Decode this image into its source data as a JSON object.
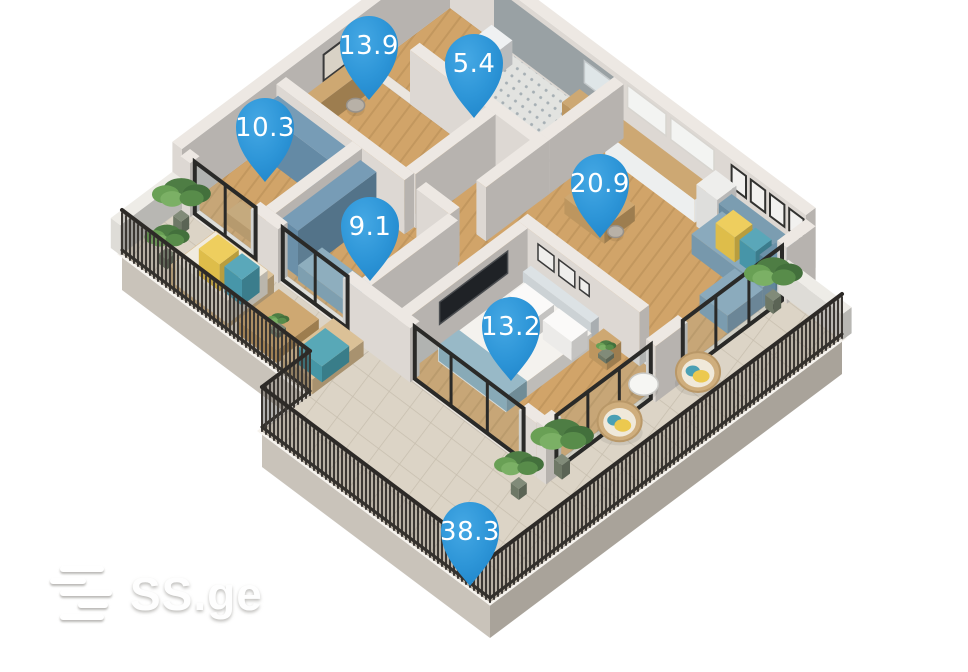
{
  "meta": {
    "width": 968,
    "height": 672,
    "background": "#ffffff"
  },
  "watermark": {
    "text": "SS.ge"
  },
  "pins": {
    "color": "#2e96d8",
    "text_color": "#ffffff",
    "items": [
      {
        "label": "13.9",
        "cx": 369,
        "cy": 45
      },
      {
        "label": "5.4",
        "cx": 474,
        "cy": 63
      },
      {
        "label": "10.3",
        "cx": 265,
        "cy": 127
      },
      {
        "label": "20.9",
        "cx": 600,
        "cy": 183
      },
      {
        "label": "9.1",
        "cx": 370,
        "cy": 226
      },
      {
        "label": "13.2",
        "cx": 511,
        "cy": 326
      },
      {
        "label": "38.3",
        "cx": 470,
        "cy": 531
      }
    ]
  },
  "scene": {
    "origin": {
      "x": 450,
      "y": 8
    },
    "kx": 0.8,
    "ky": 0.6,
    "items": [
      {
        "t": "skirt",
        "pts": [
          [
            0,
            410
          ],
          [
            235,
            410
          ],
          [
            235,
            470
          ],
          [
            520,
            470
          ],
          [
            520,
            30
          ]
        ],
        "depth": 36
      },
      {
        "t": "pf",
        "pts": [
          [
            0,
            0
          ],
          [
            445,
            0
          ],
          [
            445,
            30
          ],
          [
            520,
            30
          ],
          [
            520,
            470
          ],
          [
            235,
            470
          ],
          [
            235,
            410
          ],
          [
            0,
            410
          ]
        ],
        "f": "#ebe6df",
        "s": "#f6f3ee",
        "sw": 6
      },
      {
        "t": "pf",
        "pts": [
          [
            445,
            30
          ],
          [
            520,
            30
          ],
          [
            520,
            470
          ],
          [
            235,
            470
          ],
          [
            235,
            335
          ],
          [
            445,
            335
          ]
        ],
        "f": "@stone",
        "s": "rgba(120,108,90,0.25)",
        "sw": 1
      },
      {
        "t": "fl",
        "r": [
          0,
          335,
          235,
          410
        ],
        "f": "@stone"
      },
      {
        "t": "fl",
        "r": [
          0,
          0,
          55,
          95
        ],
        "f": "@wood"
      },
      {
        "t": "fl",
        "r": [
          55,
          0,
          205,
          95
        ],
        "f": "@tile"
      },
      {
        "t": "fl",
        "r": [
          0,
          105,
          150,
          205
        ],
        "f": "@wood"
      },
      {
        "t": "pf",
        "pts": [
          [
            160,
            105
          ],
          [
            265,
            105
          ],
          [
            265,
            325
          ],
          [
            225,
            325
          ],
          [
            225,
            217
          ],
          [
            160,
            217
          ]
        ],
        "f": "@wood"
      },
      {
        "t": "fl",
        "r": [
          0,
          215,
          95,
          325
        ],
        "f": "@wood"
      },
      {
        "t": "fl",
        "r": [
          105,
          215,
          215,
          325
        ],
        "f": "@wood"
      },
      {
        "t": "fl",
        "r": [
          215,
          0,
          445,
          172
        ],
        "f": "@wood"
      },
      {
        "t": "fl",
        "r": [
          275,
          175,
          445,
          330
        ],
        "f": "@wood"
      },
      {
        "t": "wall",
        "r": [
          -12,
          -12,
          0,
          335
        ],
        "h": 60
      },
      {
        "t": "wall",
        "r": [
          0,
          -12,
          445,
          0
        ],
        "h": 60
      },
      {
        "t": "decor",
        "w": "u",
        "at": 0,
        "r": [
          55,
          205
        ],
        "h": [
          2,
          54
        ],
        "f": "#99a1a4"
      },
      {
        "t": "decor",
        "w": "v",
        "at": 0,
        "r": [
          118,
          158
        ],
        "h": [
          22,
          48
        ],
        "f": "#d9d2c6",
        "s": "#3a3a3a",
        "sw": 2
      },
      {
        "t": "decor",
        "w": "u",
        "at": 0,
        "r": [
          222,
          270
        ],
        "h": [
          34,
          56
        ],
        "f": "#f3f4f2",
        "s": "#d8d5d0",
        "sw": 1.5
      },
      {
        "t": "decor",
        "w": "u",
        "at": 0,
        "r": [
          276,
          330
        ],
        "h": [
          34,
          56
        ],
        "f": "#f3f4f2",
        "s": "#d8d5d0",
        "sw": 1.5
      },
      {
        "t": "decor",
        "w": "u",
        "at": 0,
        "r": [
          352,
          370
        ],
        "h": [
          32,
          54
        ],
        "f": "#f2f1ef",
        "s": "#323230",
        "sw": 2
      },
      {
        "t": "decor",
        "w": "u",
        "at": 0,
        "r": [
          376,
          394
        ],
        "h": [
          32,
          54
        ],
        "f": "#f2f1ef",
        "s": "#323230",
        "sw": 2
      },
      {
        "t": "decor",
        "w": "u",
        "at": 0,
        "r": [
          400,
          418
        ],
        "h": [
          32,
          54
        ],
        "f": "#f2f1ef",
        "s": "#323230",
        "sw": 2
      },
      {
        "t": "decor",
        "w": "u",
        "at": 0,
        "r": [
          424,
          442
        ],
        "h": [
          32,
          54
        ],
        "f": "#f2f1ef",
        "s": "#323230",
        "sw": 2
      },
      {
        "t": "decor",
        "w": "u",
        "at": 0,
        "r": [
          168,
          200
        ],
        "h": [
          26,
          48
        ],
        "f": "#dfe6e8",
        "s": "#c4c9cb",
        "sw": 1.5
      },
      {
        "t": "box",
        "r": [
          60,
          8,
          86,
          34
        ],
        "h": 24,
        "c": "#eef0f1"
      },
      {
        "t": "box",
        "r": [
          166,
          4,
          204,
          26
        ],
        "h": 21,
        "c": "#c8a066"
      },
      {
        "t": "box",
        "r": [
          4,
          110,
          20,
          200
        ],
        "h": 26,
        "c": "#c9a065"
      },
      {
        "t": "disc",
        "at": [
          32,
          150
        ],
        "r": 8,
        "h": 12,
        "c": "#b8b1a7"
      },
      {
        "t": "box",
        "r": [
          165,
          108,
          215,
          122
        ],
        "h": 20,
        "c": "#c9a065"
      },
      {
        "t": "box",
        "r": [
          220,
          4,
          332,
          26
        ],
        "h": 23,
        "c": "#c8a066",
        "cl": "#edefef",
        "cr": "#dfe1e1"
      },
      {
        "t": "box",
        "r": [
          336,
          4,
          362,
          28
        ],
        "h": 42,
        "c": "#ececea"
      },
      {
        "t": "wall",
        "r": [
          55,
          93,
          217,
          105
        ]
      },
      {
        "t": "wall",
        "r": [
          205,
          0,
          217,
          93
        ]
      },
      {
        "t": "wall",
        "r": [
          150,
          105,
          162,
          205
        ]
      },
      {
        "t": "wall",
        "r": [
          205,
          93,
          217,
          172
        ]
      },
      {
        "t": "wall",
        "r": [
          0,
          205,
          160,
          217
        ]
      },
      {
        "t": "wall",
        "r": [
          175,
          205,
          217,
          217
        ]
      },
      {
        "t": "box",
        "r": [
          4,
          219,
          90,
          241
        ],
        "h": 46,
        "c": "#6a93af"
      },
      {
        "t": "box",
        "r": [
          40,
          302,
          80,
          320
        ],
        "h": 12,
        "c": "#c9a065"
      },
      {
        "t": "wall",
        "r": [
          95,
          217,
          107,
          325
        ]
      },
      {
        "t": "box",
        "r": [
          109,
          221,
          129,
          319
        ],
        "h": 46,
        "c": "#6a93af"
      },
      {
        "t": "box",
        "r": [
          243,
          62,
          293,
          100
        ],
        "h": 16,
        "c": "#c9a065"
      },
      {
        "t": "disc",
        "at": [
          237,
          72
        ],
        "r": 7,
        "h": 11,
        "c": "#b8b1a7"
      },
      {
        "t": "disc",
        "at": [
          299,
          92
        ],
        "r": 7,
        "h": 11,
        "c": "#b8b1a7"
      },
      {
        "t": "box",
        "r": [
          356,
          4,
          445,
          20
        ],
        "h": 30,
        "c": "#6f94aa"
      },
      {
        "t": "box",
        "r": [
          356,
          16,
          445,
          54
        ],
        "h": 20,
        "c": "#7fa2b7"
      },
      {
        "t": "box",
        "r": [
          410,
          54,
          445,
          98
        ],
        "h": 18,
        "c": "#7fa2b7"
      },
      {
        "t": "box",
        "r": [
          366,
          12,
          390,
          34
        ],
        "h": 25,
        "c": "#ecc94f"
      },
      {
        "t": "box",
        "r": [
          394,
          12,
          414,
          32
        ],
        "h": 24,
        "c": "#4b9fb3"
      },
      {
        "t": "box",
        "r": [
          419,
          12,
          439,
          32
        ],
        "h": 24,
        "c": "#5d87a0"
      },
      {
        "t": "box",
        "r": [
          132,
          292,
          198,
          322
        ],
        "h": 15,
        "c": "#82a5b8"
      },
      {
        "t": "wall",
        "r": [
          215,
          217,
          227,
          325
        ]
      },
      {
        "t": "wall",
        "r": [
          265,
          168,
          417,
          180
        ]
      },
      {
        "t": "decor",
        "w": "u",
        "at": 180,
        "r": [
          290,
          310
        ],
        "h": [
          30,
          46
        ],
        "f": "#efeeec",
        "s": "#3a3a3a",
        "sw": 1.5
      },
      {
        "t": "decor",
        "w": "u",
        "at": 180,
        "r": [
          316,
          336
        ],
        "h": [
          30,
          46
        ],
        "f": "#efeeec",
        "s": "#3a3a3a",
        "sw": 1.5
      },
      {
        "t": "decor",
        "w": "u",
        "at": 180,
        "r": [
          342,
          354
        ],
        "h": [
          32,
          44
        ],
        "f": "#efeeec",
        "s": "#3a3a3a",
        "sw": 1.5
      },
      {
        "t": "wall",
        "r": [
          265,
          180,
          277,
          330
        ]
      },
      {
        "t": "decor",
        "w": "v",
        "at": 277,
        "r": [
          205,
          290
        ],
        "h": [
          24,
          46
        ],
        "f": "#1f2226",
        "s": "#4a4d50",
        "sw": 1.5
      },
      {
        "t": "box",
        "r": [
          287,
          186,
          372,
          196
        ],
        "h": 26,
        "c": "#d9dfe3"
      },
      {
        "t": "box",
        "r": [
          287,
          195,
          372,
          302
        ],
        "h": 15,
        "c": "#f3f1ec"
      },
      {
        "t": "box",
        "r": [
          292,
          198,
          328,
          218
        ],
        "h": 19,
        "c": "#fbfaf8"
      },
      {
        "t": "box",
        "r": [
          334,
          198,
          370,
          218
        ],
        "h": 19,
        "c": "#fbfaf8"
      },
      {
        "t": "box",
        "r": [
          287,
          276,
          372,
          301
        ],
        "h": 16,
        "c": "#8fb3c2"
      },
      {
        "t": "box",
        "r": [
          378,
          186,
          400,
          204
        ],
        "h": 18,
        "c": "#c9a065"
      },
      {
        "t": "plant",
        "at": [
          389,
          194
        ],
        "s": 9
      },
      {
        "t": "wall",
        "r": [
          0,
          325,
          12,
          337
        ]
      },
      {
        "t": "wall",
        "r": [
          88,
          325,
          122,
          337
        ]
      },
      {
        "t": "wall",
        "r": [
          203,
          325,
          287,
          337
        ]
      },
      {
        "t": "wall",
        "r": [
          423,
          325,
          445,
          337
        ]
      },
      {
        "t": "glass",
        "w": "u",
        "at": 331,
        "r": [
          12,
          88
        ],
        "h": 52
      },
      {
        "t": "glass",
        "w": "u",
        "at": 331,
        "r": [
          122,
          203
        ],
        "h": 52
      },
      {
        "t": "glass",
        "w": "u",
        "at": 331,
        "r": [
          287,
          423
        ],
        "h": 52
      },
      {
        "t": "wall",
        "r": [
          445,
          0,
          457,
          36
        ],
        "h": 56
      },
      {
        "t": "wall",
        "r": [
          445,
          160,
          457,
          200
        ],
        "h": 56
      },
      {
        "t": "wall",
        "r": [
          445,
          318,
          457,
          337
        ],
        "h": 56
      },
      {
        "t": "glass",
        "w": "v",
        "at": 451,
        "r": [
          36,
          160
        ],
        "h": 54
      },
      {
        "t": "glass",
        "w": "v",
        "at": 451,
        "r": [
          200,
          318
        ],
        "h": 54
      },
      {
        "t": "box",
        "r": [
          -12,
          335,
          0,
          412
        ],
        "h": 30,
        "c": "#eceae5"
      },
      {
        "t": "box",
        "r": [
          443,
          20,
          522,
          32
        ],
        "h": 26,
        "c": "#eceae5"
      },
      {
        "t": "plant",
        "at": [
          16,
          352
        ],
        "s": 26
      },
      {
        "t": "plant",
        "at": [
          36,
          390
        ],
        "s": 20
      },
      {
        "t": "box",
        "r": [
          55,
          348,
          128,
          406
        ],
        "h": 19,
        "c": "#d8bb8e"
      },
      {
        "t": "box",
        "r": [
          59,
          352,
          124,
          402
        ],
        "h": 23,
        "c": "#efe9dc"
      },
      {
        "t": "box",
        "r": [
          66,
          356,
          92,
          380
        ],
        "h": 27,
        "c": "#ecc94f"
      },
      {
        "t": "box",
        "r": [
          96,
          356,
          118,
          378
        ],
        "h": 26,
        "c": "#4ba0b4"
      },
      {
        "t": "box",
        "r": [
          138,
          352,
          188,
          404
        ],
        "h": 13,
        "c": "#c9a065"
      },
      {
        "t": "plant",
        "at": [
          163,
          378
        ],
        "s": 10
      },
      {
        "t": "box",
        "r": [
          198,
          344,
          236,
          408
        ],
        "h": 15,
        "c": "#d8bb8e"
      },
      {
        "t": "box",
        "r": [
          202,
          358,
          232,
          392
        ],
        "h": 16,
        "c": "#49a0b0"
      },
      {
        "t": "plant",
        "at": [
          452,
          48
        ],
        "s": 26
      },
      {
        "t": "plant",
        "at": [
          458,
          318
        ],
        "s": 28
      },
      {
        "t": "plant",
        "at": [
          448,
          362
        ],
        "s": 22
      },
      {
        "t": "egg",
        "at": [
          468,
          158
        ],
        "r": 21
      },
      {
        "t": "egg",
        "at": [
          460,
          248
        ],
        "r": 21
      },
      {
        "t": "disc",
        "at": [
          447,
          205
        ],
        "r": 13,
        "h": 15,
        "c": "#f6f6f3"
      },
      {
        "t": "fence",
        "a": [
          0,
          410
        ],
        "b": [
          235,
          410
        ],
        "h": 44
      },
      {
        "t": "fence",
        "a": [
          235,
          410
        ],
        "b": [
          235,
          470
        ],
        "h": 44
      },
      {
        "t": "fence",
        "a": [
          235,
          470
        ],
        "b": [
          520,
          470
        ],
        "h": 44
      },
      {
        "t": "fence",
        "a": [
          520,
          470
        ],
        "b": [
          520,
          30
        ],
        "h": 44
      }
    ]
  }
}
